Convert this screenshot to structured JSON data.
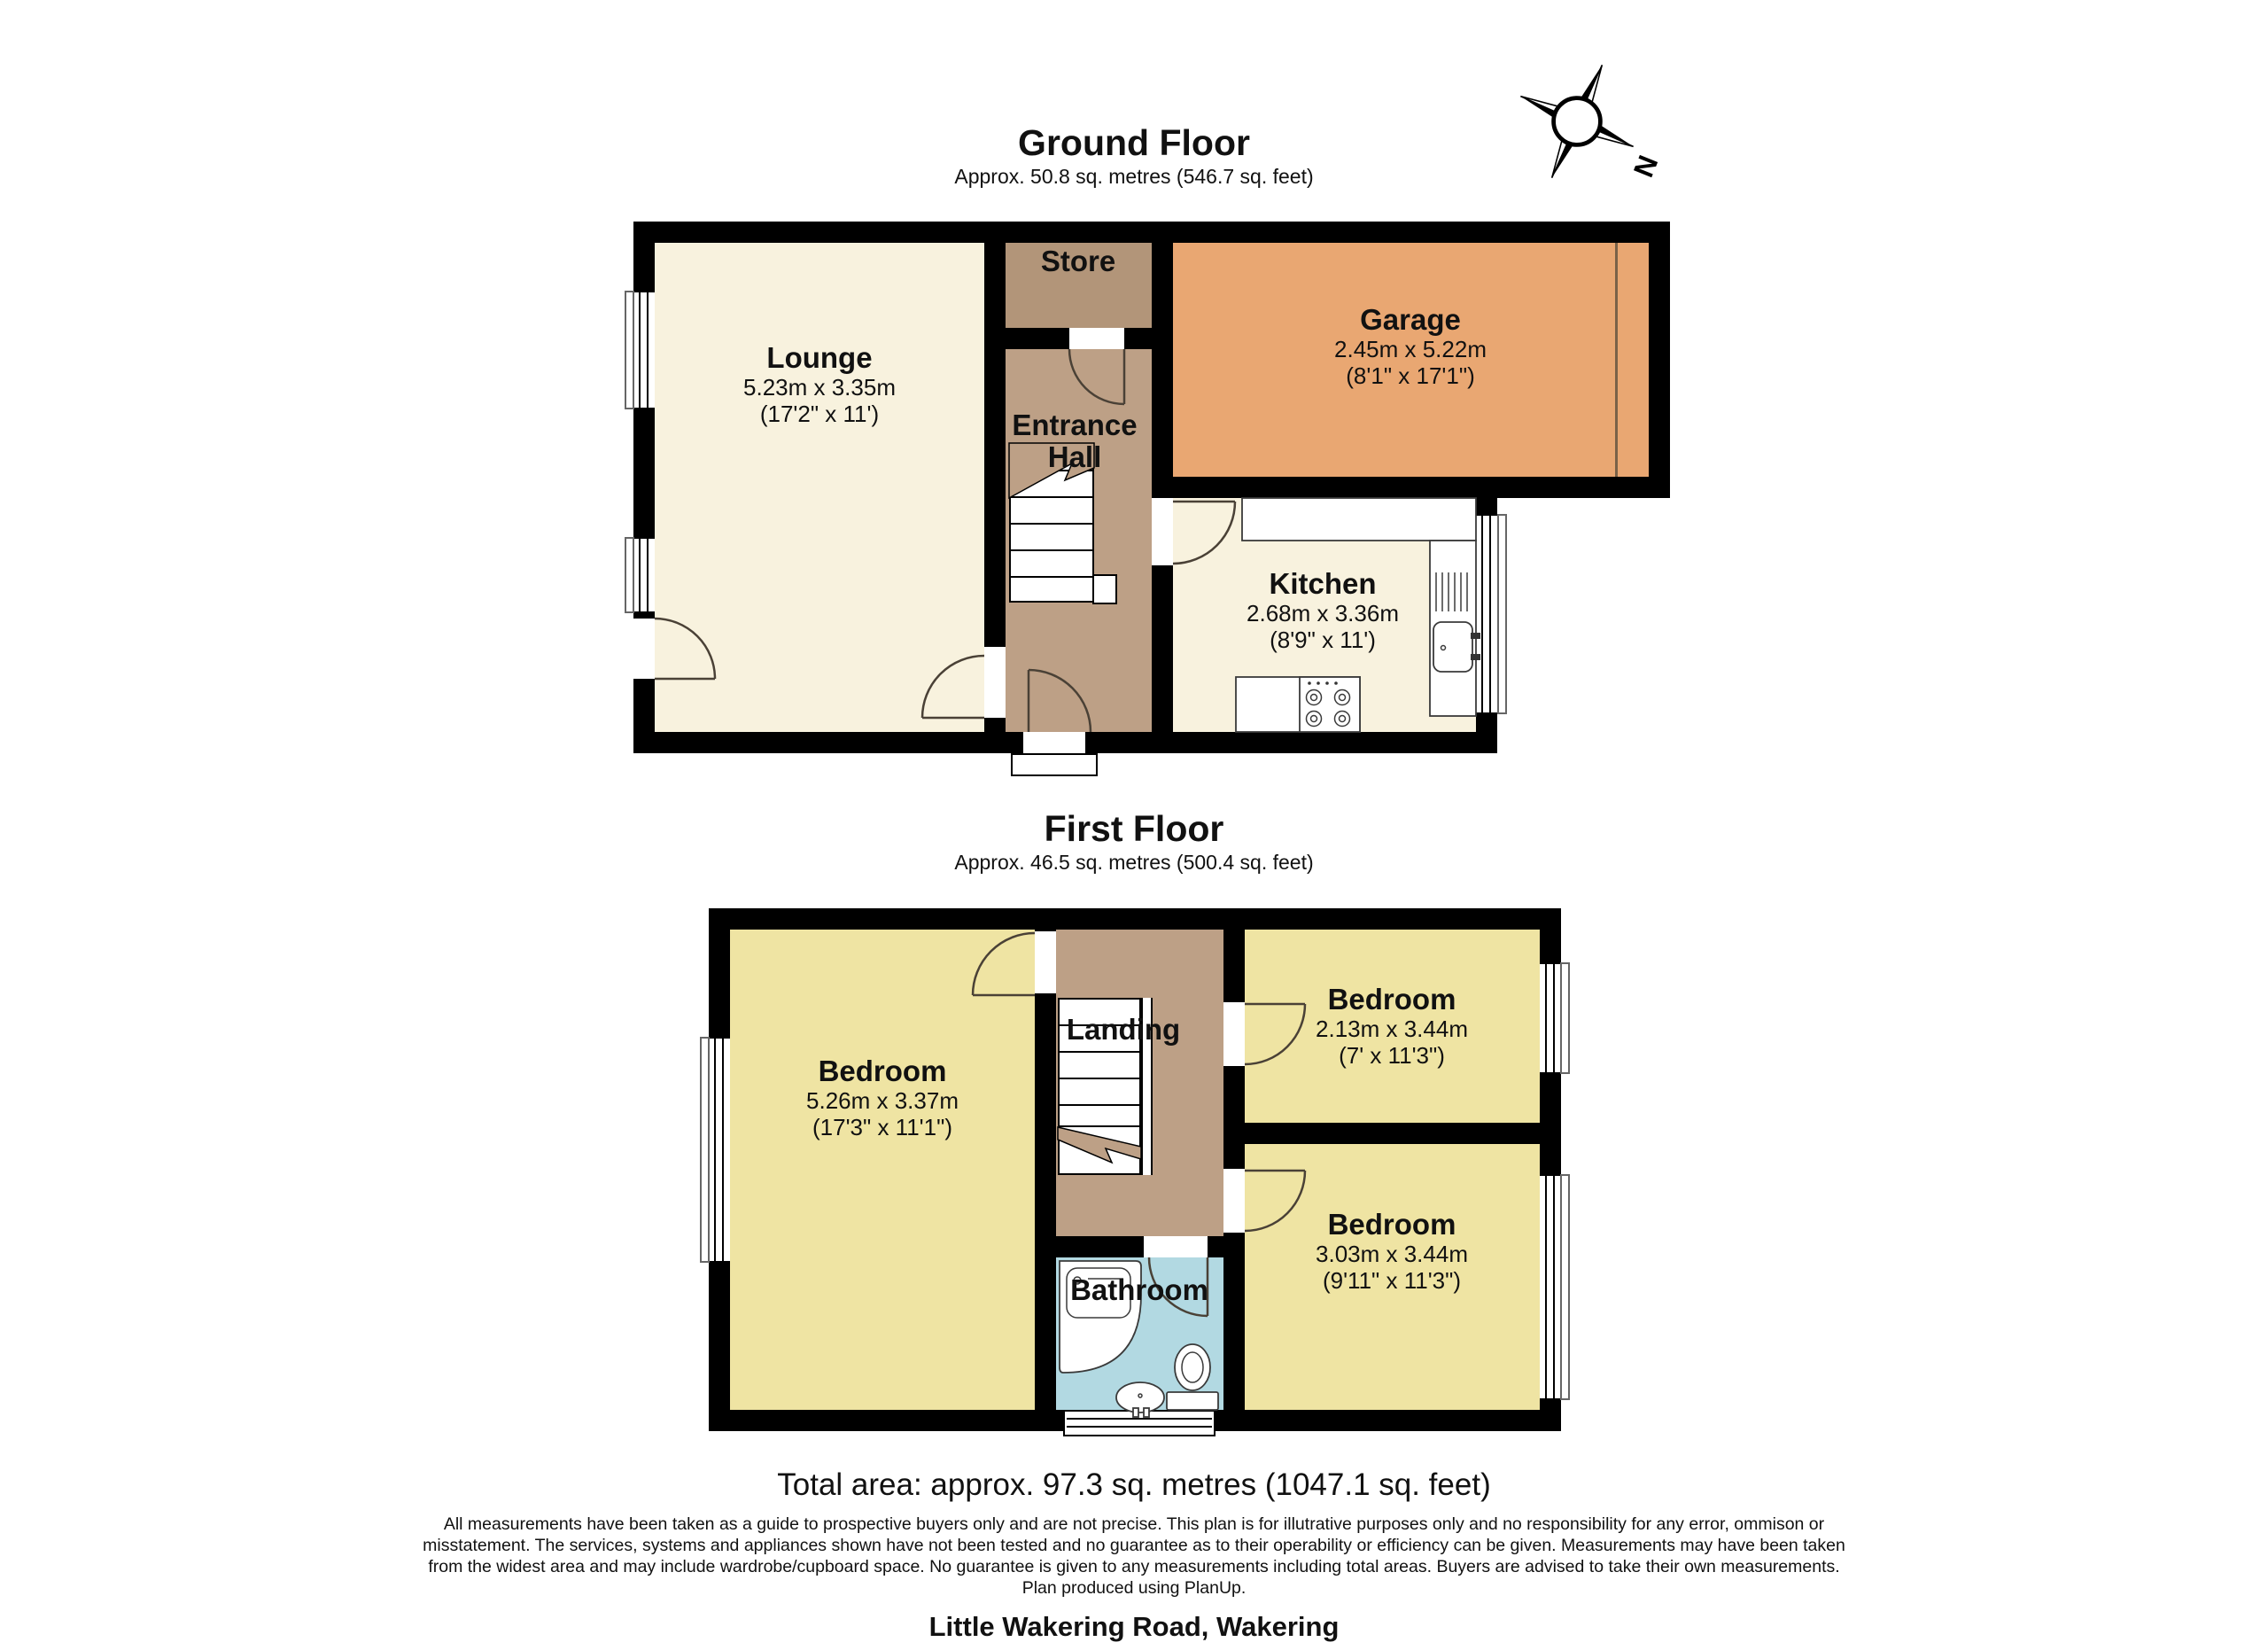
{
  "compass": {
    "north_label": "N"
  },
  "ground_floor": {
    "title": "Ground Floor",
    "subtitle": "Approx. 50.8 sq. metres (546.7 sq. feet)",
    "rooms": {
      "lounge": {
        "name": "Lounge",
        "dims_metric": "5.23m x 3.35m",
        "dims_imperial": "(17'2\" x 11')"
      },
      "store": {
        "name": "Store"
      },
      "entrance_hall": {
        "name_line1": "Entrance",
        "name_line2": "Hall"
      },
      "garage": {
        "name": "Garage",
        "dims_metric": "2.45m x 5.22m",
        "dims_imperial": "(8'1\" x 17'1\")"
      },
      "kitchen": {
        "name": "Kitchen",
        "dims_metric": "2.68m x 3.36m",
        "dims_imperial": "(8'9\" x 11')"
      }
    }
  },
  "first_floor": {
    "title": "First Floor",
    "subtitle": "Approx. 46.5 sq. metres (500.4 sq. feet)",
    "rooms": {
      "bedroom_left": {
        "name": "Bedroom",
        "dims_metric": "5.26m x 3.37m",
        "dims_imperial": "(17'3\" x 11'1\")"
      },
      "landing": {
        "name": "Landing"
      },
      "bedroom_top_right": {
        "name": "Bedroom",
        "dims_metric": "2.13m x 3.44m",
        "dims_imperial": "(7' x 11'3\")"
      },
      "bedroom_bottom_right": {
        "name": "Bedroom",
        "dims_metric": "3.03m x 3.44m",
        "dims_imperial": "(9'11\" x 11'3\")"
      },
      "bathroom": {
        "name": "Bathroom"
      }
    }
  },
  "footer": {
    "total_area": "Total area: approx. 97.3 sq. metres (1047.1 sq. feet)",
    "disclaimer_lines": [
      "All measurements have been taken as a guide to prospective buyers only and are not precise. This plan is for illutrative purposes only and no responsibility for any error, ommison or",
      "misstatement. The services, systems and appliances shown have not been tested and no guarantee as to their operability or efficiency can be given. Measurements may have been taken",
      "from the widest area and may include wardrobe/cupboard space. No guarantee is given to any measurements including total areas. Buyers are advised to take their own measurements.",
      "Plan produced using PlanUp."
    ],
    "address": "Little Wakering Road, Wakering"
  },
  "colors": {
    "wall": "#000000",
    "cream": "#f8f2de",
    "hall": "#bda086",
    "store": "#b29579",
    "garage": "#e9a772",
    "bedroom": "#efe4a3",
    "bathroom": "#b2d9e2",
    "arc": "#4a4136",
    "text": "#111111"
  }
}
